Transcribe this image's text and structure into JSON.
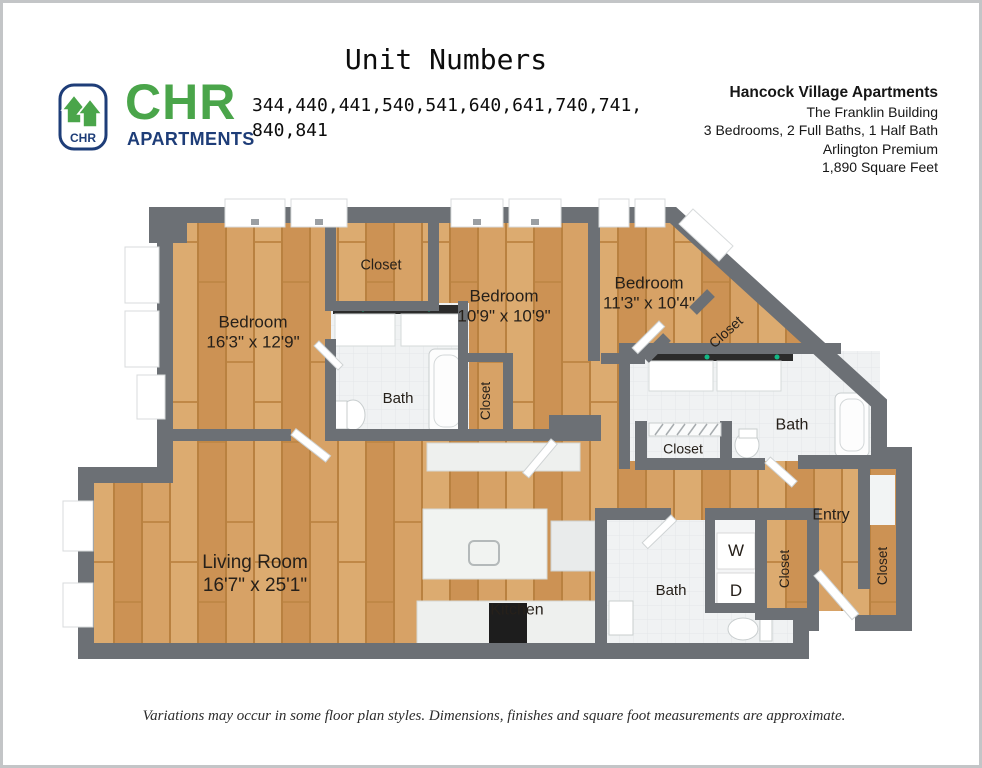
{
  "header": {
    "title": "Unit Numbers",
    "logo": {
      "brand": "CHR",
      "brand_sub": "APARTMENTS",
      "badge_text": "CHR"
    },
    "unit_numbers_line1": "344,440,441,540,541,640,641,740,741,",
    "unit_numbers_line2": "840,841",
    "property": {
      "name": "Hancock Village Apartments",
      "building": "The Franklin Building",
      "layout": "3 Bedrooms, 2 Full Baths, 1 Half Bath",
      "style": "Arlington Premium",
      "area": "1,890 Square Feet"
    }
  },
  "floorplan": {
    "bedroom1": {
      "label": "Bedroom",
      "dims": "16'3\" x 12'9\""
    },
    "bedroom2": {
      "label": "Bedroom",
      "dims": "10'9\" x 10'9\""
    },
    "bedroom3": {
      "label": "Bedroom",
      "dims": "11'3\" x 10'4\""
    },
    "living": {
      "label": "Living Room",
      "dims": "16'7\" x 25'1\""
    },
    "kitchen": {
      "label": "Kitchen"
    },
    "entry": {
      "label": "Entry"
    },
    "bath_upper": {
      "label": "Bath"
    },
    "bath_master": {
      "label": "Bath"
    },
    "bath_half": {
      "label": "Bath"
    },
    "closet_top": {
      "label": "Closet"
    },
    "closet_bedroom2": {
      "label": "Closet"
    },
    "closet_walkin": {
      "label": "Closet"
    },
    "closet_hall": {
      "label": "Closet"
    },
    "closet_entry_left": {
      "label": "Closet"
    },
    "closet_entry_right": {
      "label": "Closet"
    },
    "washer": {
      "label": "W"
    },
    "dryer": {
      "label": "D"
    }
  },
  "footer": {
    "disclaimer": "Variations may occur in some floor plan styles. Dimensions, finishes and square foot measurements are approximate."
  },
  "colors": {
    "wall": "#6c7075",
    "wood": "#d5a062",
    "tile": "#f0f2f3",
    "logo_green": "#4aa54a",
    "logo_navy": "#1e3d78"
  }
}
